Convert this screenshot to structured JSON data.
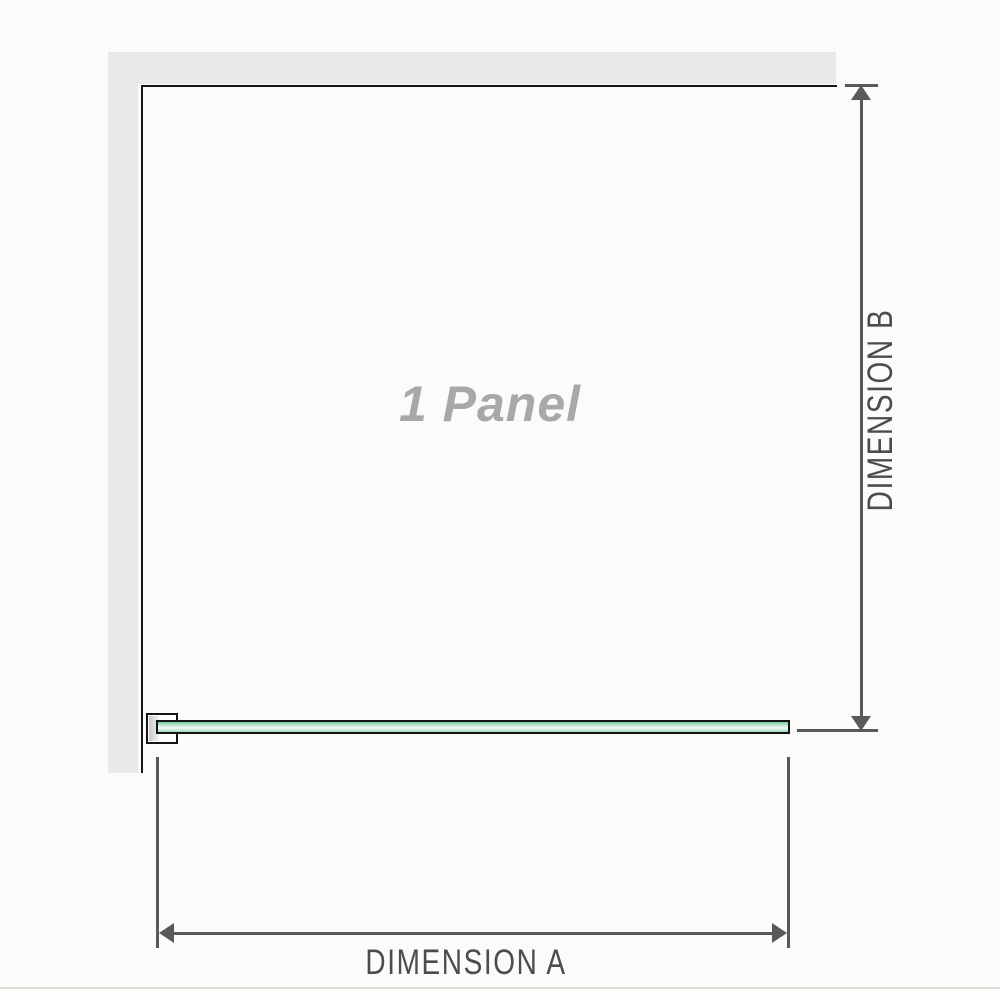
{
  "diagram": {
    "panel_label": "1 Panel",
    "dimension_a_label": "DIMENSION A",
    "dimension_b_label": "DIMENSION B"
  },
  "colors": {
    "background": "#fcfbf9",
    "wall": "#e9e9e9",
    "outline": "#141414",
    "dimension": "#58595b",
    "dimension_text": "#4c4c4c",
    "panel_text": "#a8a8a8",
    "glass_dark": "#7cc7a1",
    "glass_mid": "#9bd6b6",
    "glass_light": "#eef9f3",
    "rule": "#dcdbd5"
  }
}
